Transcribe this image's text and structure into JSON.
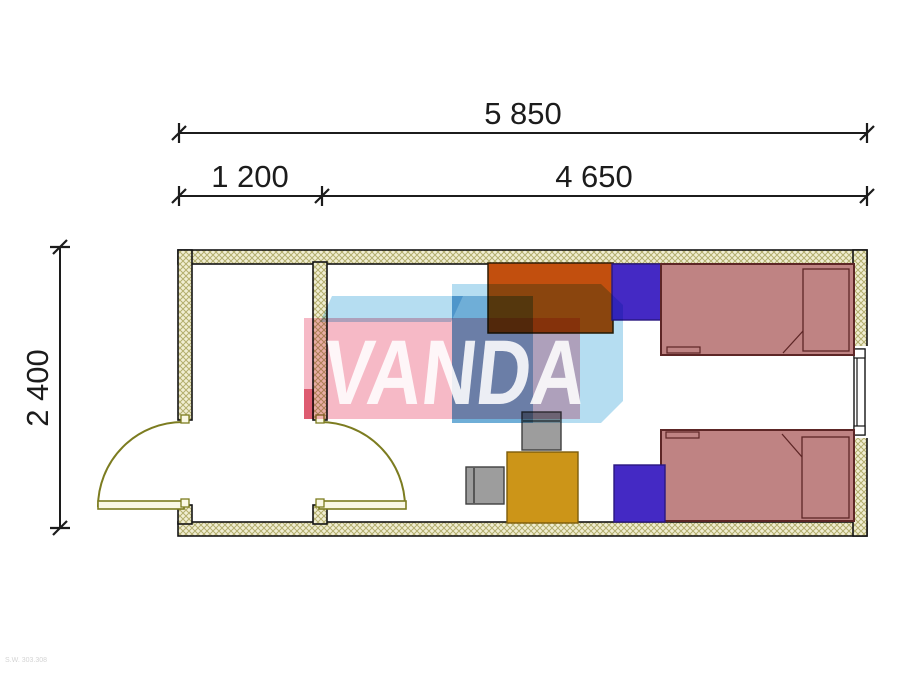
{
  "drawing": {
    "type": "architectural-floor-plan",
    "unit": "mm",
    "dimensions": {
      "total_width_label": "5 850",
      "vestibule_width_label": "1 200",
      "main_room_width_label": "4 650",
      "depth_label": "2 400"
    },
    "watermark": {
      "text": "VANDA",
      "pink_box_color": "#f6b9c6",
      "blue_box_color": "#b5ddf1",
      "blue_dark_color": "#9cc9e4",
      "red_strip_color": "#e77f92"
    },
    "corner_note": "S.W. 303.308",
    "rooms": [
      {
        "name": "vestibule",
        "width_mm": 1200
      },
      {
        "name": "bedroom",
        "width_mm": 4650
      }
    ],
    "furniture": [
      {
        "name": "wardrobe",
        "color": "#c24f0e"
      },
      {
        "name": "nightstand-top",
        "color": "#4429c4"
      },
      {
        "name": "nightstand-bottom",
        "color": "#4429c4"
      },
      {
        "name": "single-bed-top",
        "color": "#bf8383"
      },
      {
        "name": "single-bed-bottom",
        "color": "#bf8383"
      },
      {
        "name": "table",
        "color": "#cc9518"
      },
      {
        "name": "chair-top",
        "color": "#9d9d9d"
      },
      {
        "name": "chair-left",
        "color": "#9d9d9d"
      }
    ],
    "elements": {
      "doors": [
        "exterior-door-left-swing",
        "interior-door-partition-swing"
      ],
      "window": "window-right-wall",
      "wall_hatch_background": "#f1eed3",
      "wall_hatch_line": "#b3ae6e",
      "door_line_color": "#7c7c20",
      "dimension_line_color": "#1c1c1c"
    }
  }
}
